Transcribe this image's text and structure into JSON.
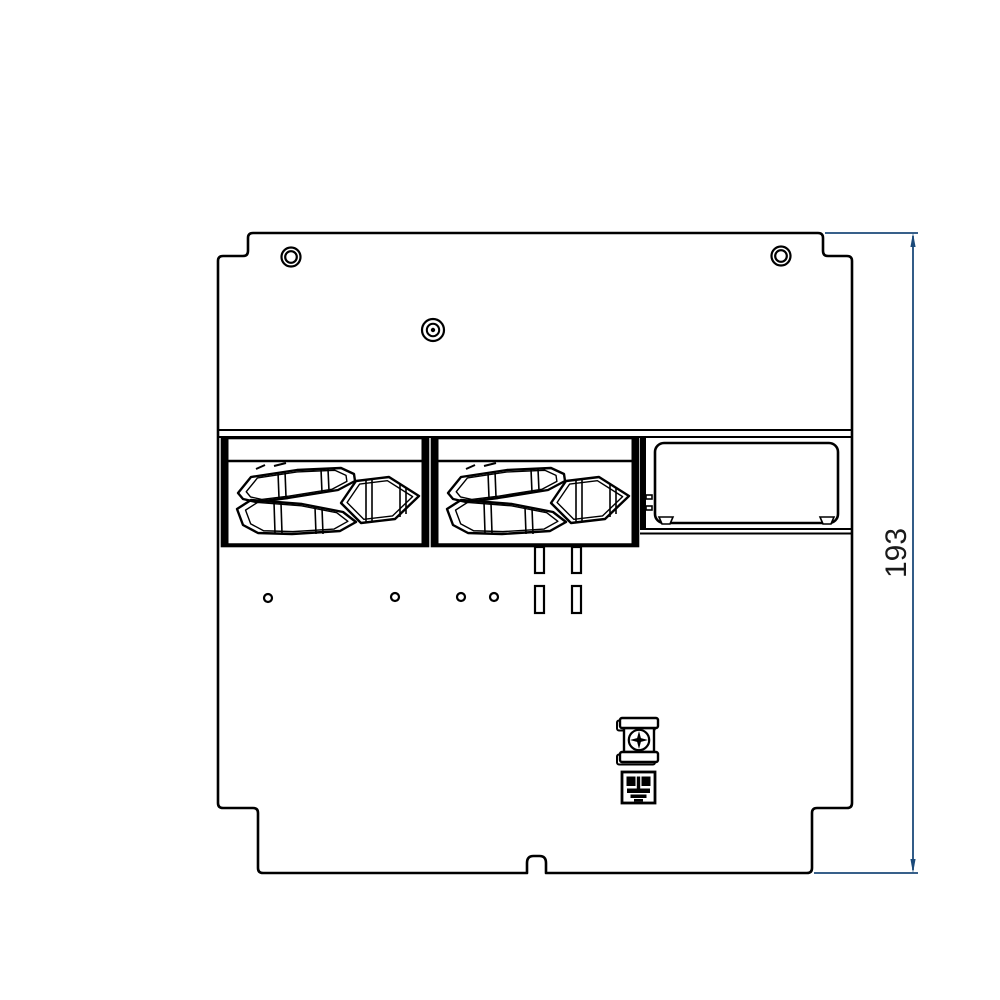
{
  "canvas": {
    "width": 1000,
    "height": 1000,
    "background": "#ffffff"
  },
  "drawing": {
    "subject": "mounting-plate-front-view",
    "line_color": "#000000",
    "dimension": {
      "value": "193",
      "orientation": "vertical",
      "line_color": "#1b4a7a",
      "text_color": "#1a1a1a"
    },
    "features": {
      "screw_holes_top": 2,
      "center_fastener": 1,
      "cable_entry_modules": 2,
      "membrane_grommets_per_module": 3,
      "rectangular_cutout": 1,
      "pilot_holes": 4,
      "mounting_slots": 4,
      "ground_screw_terminal": 1,
      "earth_symbol_label": 1,
      "bottom_edge_notch": 1
    }
  }
}
